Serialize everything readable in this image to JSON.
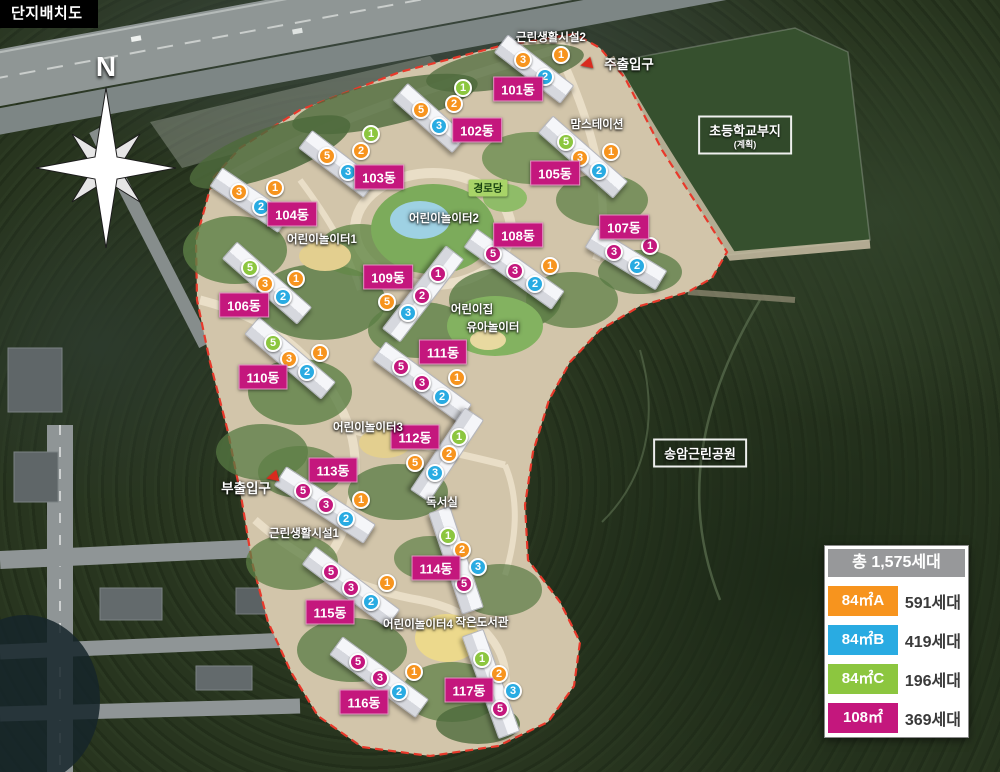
{
  "title": "단지배치도",
  "compass_label": "N",
  "colors": {
    "a": "#F7941E",
    "b": "#29ABE2",
    "c": "#8CC63F",
    "m": "#C4177D",
    "label_bg": "#C4177D",
    "legend_header": "#97989A",
    "boundary": "#E8392B"
  },
  "legend": {
    "total_label": "총 1,575세대",
    "rows": [
      {
        "type": "a",
        "label": "84㎡A",
        "value": "591세대"
      },
      {
        "type": "b",
        "label": "84㎡B",
        "value": "419세대"
      },
      {
        "type": "c",
        "label": "84㎡C",
        "value": "196세대"
      },
      {
        "type": "m",
        "label": "108㎡",
        "value": "369세대"
      }
    ]
  },
  "map": {
    "buildings": [
      {
        "name": "101동",
        "label": {
          "x": 518,
          "y": 89
        },
        "units": [
          {
            "n": "3",
            "t": "a",
            "x": 523,
            "y": 60
          },
          {
            "n": "1",
            "t": "a",
            "x": 561,
            "y": 55
          },
          {
            "n": "2",
            "t": "b",
            "x": 545,
            "y": 77
          }
        ]
      },
      {
        "name": "102동",
        "label": {
          "x": 477,
          "y": 130
        },
        "units": [
          {
            "n": "5",
            "t": "a",
            "x": 421,
            "y": 110
          },
          {
            "n": "1",
            "t": "c",
            "x": 463,
            "y": 88
          },
          {
            "n": "2",
            "t": "a",
            "x": 454,
            "y": 104
          },
          {
            "n": "3",
            "t": "b",
            "x": 439,
            "y": 126
          }
        ]
      },
      {
        "name": "103동",
        "label": {
          "x": 379,
          "y": 177
        },
        "units": [
          {
            "n": "5",
            "t": "a",
            "x": 327,
            "y": 156
          },
          {
            "n": "1",
            "t": "c",
            "x": 371,
            "y": 134
          },
          {
            "n": "2",
            "t": "a",
            "x": 361,
            "y": 151
          },
          {
            "n": "3",
            "t": "b",
            "x": 348,
            "y": 172
          }
        ]
      },
      {
        "name": "104동",
        "label": {
          "x": 292,
          "y": 214
        },
        "units": [
          {
            "n": "3",
            "t": "a",
            "x": 239,
            "y": 192
          },
          {
            "n": "1",
            "t": "a",
            "x": 275,
            "y": 188
          },
          {
            "n": "2",
            "t": "b",
            "x": 261,
            "y": 207
          }
        ]
      },
      {
        "name": "105동",
        "label": {
          "x": 555,
          "y": 173
        },
        "units": [
          {
            "n": "5",
            "t": "c",
            "x": 566,
            "y": 142
          },
          {
            "n": "3",
            "t": "a",
            "x": 580,
            "y": 158
          },
          {
            "n": "1",
            "t": "a",
            "x": 611,
            "y": 152
          },
          {
            "n": "2",
            "t": "b",
            "x": 599,
            "y": 171
          }
        ]
      },
      {
        "name": "106동",
        "label": {
          "x": 244,
          "y": 305
        },
        "units": [
          {
            "n": "5",
            "t": "c",
            "x": 250,
            "y": 268
          },
          {
            "n": "3",
            "t": "a",
            "x": 265,
            "y": 284
          },
          {
            "n": "1",
            "t": "a",
            "x": 296,
            "y": 279
          },
          {
            "n": "2",
            "t": "b",
            "x": 283,
            "y": 297
          }
        ]
      },
      {
        "name": "107동",
        "label": {
          "x": 624,
          "y": 227
        },
        "units": [
          {
            "n": "3",
            "t": "m",
            "x": 614,
            "y": 252
          },
          {
            "n": "1",
            "t": "m",
            "x": 650,
            "y": 246
          },
          {
            "n": "2",
            "t": "b",
            "x": 637,
            "y": 266
          }
        ]
      },
      {
        "name": "108동",
        "label": {
          "x": 518,
          "y": 235
        },
        "units": [
          {
            "n": "5",
            "t": "m",
            "x": 493,
            "y": 254
          },
          {
            "n": "3",
            "t": "m",
            "x": 515,
            "y": 271
          },
          {
            "n": "1",
            "t": "a",
            "x": 550,
            "y": 266
          },
          {
            "n": "2",
            "t": "b",
            "x": 535,
            "y": 284
          }
        ]
      },
      {
        "name": "109동",
        "label": {
          "x": 388,
          "y": 277
        },
        "units": [
          {
            "n": "1",
            "t": "m",
            "x": 438,
            "y": 274
          },
          {
            "n": "2",
            "t": "m",
            "x": 422,
            "y": 296
          },
          {
            "n": "5",
            "t": "a",
            "x": 387,
            "y": 302
          },
          {
            "n": "3",
            "t": "b",
            "x": 408,
            "y": 313
          }
        ]
      },
      {
        "name": "110동",
        "label": {
          "x": 263,
          "y": 377
        },
        "units": [
          {
            "n": "5",
            "t": "c",
            "x": 273,
            "y": 343
          },
          {
            "n": "3",
            "t": "a",
            "x": 289,
            "y": 359
          },
          {
            "n": "1",
            "t": "a",
            "x": 320,
            "y": 353
          },
          {
            "n": "2",
            "t": "b",
            "x": 307,
            "y": 372
          }
        ]
      },
      {
        "name": "111동",
        "label": {
          "x": 443,
          "y": 352
        },
        "units": [
          {
            "n": "5",
            "t": "m",
            "x": 401,
            "y": 367
          },
          {
            "n": "3",
            "t": "m",
            "x": 422,
            "y": 383
          },
          {
            "n": "1",
            "t": "a",
            "x": 457,
            "y": 378
          },
          {
            "n": "2",
            "t": "b",
            "x": 442,
            "y": 397
          }
        ]
      },
      {
        "name": "112동",
        "label": {
          "x": 415,
          "y": 437
        },
        "units": [
          {
            "n": "1",
            "t": "c",
            "x": 459,
            "y": 437
          },
          {
            "n": "2",
            "t": "a",
            "x": 449,
            "y": 454
          },
          {
            "n": "5",
            "t": "a",
            "x": 415,
            "y": 463
          },
          {
            "n": "3",
            "t": "b",
            "x": 435,
            "y": 473
          }
        ]
      },
      {
        "name": "113동",
        "label": {
          "x": 333,
          "y": 470
        },
        "units": [
          {
            "n": "5",
            "t": "m",
            "x": 303,
            "y": 491
          },
          {
            "n": "3",
            "t": "m",
            "x": 326,
            "y": 505
          },
          {
            "n": "1",
            "t": "a",
            "x": 361,
            "y": 500
          },
          {
            "n": "2",
            "t": "b",
            "x": 346,
            "y": 519
          }
        ]
      },
      {
        "name": "114동",
        "label": {
          "x": 436,
          "y": 568
        },
        "units": [
          {
            "n": "1",
            "t": "c",
            "x": 448,
            "y": 536
          },
          {
            "n": "2",
            "t": "a",
            "x": 462,
            "y": 550
          },
          {
            "n": "3",
            "t": "b",
            "x": 478,
            "y": 567
          },
          {
            "n": "5",
            "t": "m",
            "x": 464,
            "y": 584
          }
        ]
      },
      {
        "name": "115동",
        "label": {
          "x": 330,
          "y": 612
        },
        "units": [
          {
            "n": "5",
            "t": "m",
            "x": 331,
            "y": 572
          },
          {
            "n": "3",
            "t": "m",
            "x": 351,
            "y": 588
          },
          {
            "n": "1",
            "t": "a",
            "x": 387,
            "y": 583
          },
          {
            "n": "2",
            "t": "b",
            "x": 371,
            "y": 602
          }
        ]
      },
      {
        "name": "116동",
        "label": {
          "x": 364,
          "y": 702
        },
        "units": [
          {
            "n": "5",
            "t": "m",
            "x": 358,
            "y": 662
          },
          {
            "n": "3",
            "t": "m",
            "x": 380,
            "y": 678
          },
          {
            "n": "1",
            "t": "a",
            "x": 414,
            "y": 672
          },
          {
            "n": "2",
            "t": "b",
            "x": 399,
            "y": 692
          }
        ]
      },
      {
        "name": "117동",
        "label": {
          "x": 469,
          "y": 690
        },
        "units": [
          {
            "n": "1",
            "t": "c",
            "x": 482,
            "y": 659
          },
          {
            "n": "2",
            "t": "a",
            "x": 499,
            "y": 674
          },
          {
            "n": "3",
            "t": "b",
            "x": 513,
            "y": 691
          },
          {
            "n": "5",
            "t": "m",
            "x": 500,
            "y": 709
          }
        ]
      }
    ],
    "facilities": [
      {
        "label": "근린생활시설2",
        "x": 551,
        "y": 37
      },
      {
        "label": "맘스테이션",
        "x": 597,
        "y": 124
      },
      {
        "label": "어린이놀이터1",
        "x": 322,
        "y": 239
      },
      {
        "label": "어린이놀이터2",
        "x": 444,
        "y": 218
      },
      {
        "label": "어린이집",
        "x": 472,
        "y": 309
      },
      {
        "label": "유아놀이터",
        "x": 493,
        "y": 327
      },
      {
        "label": "어린이놀이터3",
        "x": 368,
        "y": 427
      },
      {
        "label": "근린생활시설1",
        "x": 304,
        "y": 533
      },
      {
        "label": "독서실",
        "x": 442,
        "y": 502
      },
      {
        "label": "어린이놀이터4",
        "x": 418,
        "y": 624
      },
      {
        "label": "작은도서관",
        "x": 482,
        "y": 622
      }
    ],
    "senior_center": {
      "label": "경로당",
      "x": 488,
      "y": 188
    },
    "entrances": [
      {
        "label": "주출입구",
        "x": 629,
        "y": 63,
        "flag": {
          "x": 586,
          "y": 64
        }
      },
      {
        "label": "부출입구",
        "x": 246,
        "y": 487,
        "flag": {
          "x": 272,
          "y": 477
        }
      }
    ],
    "areas": [
      {
        "label": "초등학교부지",
        "sub": "(계획)",
        "x": 745,
        "y": 135
      },
      {
        "label": "송암근린공원",
        "sub": "",
        "x": 700,
        "y": 453
      }
    ]
  }
}
